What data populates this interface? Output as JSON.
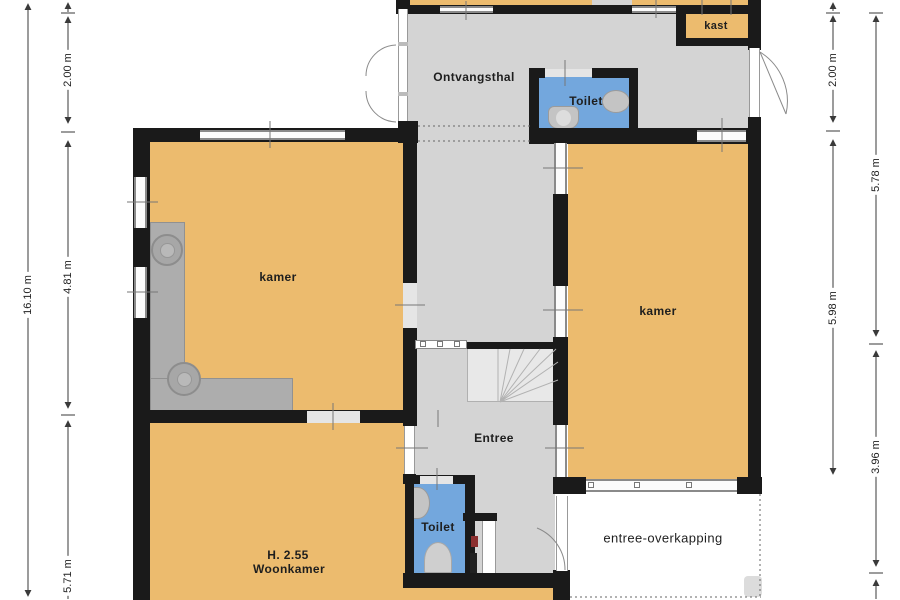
{
  "plan": {
    "rooms": {
      "ontvangsthal": "Ontvangsthal",
      "kast": "kast",
      "toilet_top": "Toilet",
      "kamer_left": "kamer",
      "kamer_right": "kamer",
      "entree": "Entree",
      "toilet_bottom": "Toilet",
      "woonkamer_height": "H. 2.55",
      "woonkamer": "Woonkamer",
      "entree_overkapping": "entree-overkapping"
    },
    "dimensions": {
      "left_total": "16.10 m",
      "left_top": "2.00 m",
      "left_middle": "4.81 m",
      "left_bottom": "5.71 m",
      "right_inner_top": "2.00 m",
      "right_inner_bottom": "5.98 m",
      "right_outer_top": "5.78 m",
      "right_outer_bottom": "3.96 m"
    }
  },
  "colors": {
    "wall": "#1a1a1a",
    "room-fill": "#ECBB6E",
    "hall-fill": "#D4D4D4",
    "wet-fill": "#73A7DD",
    "stairs-fill": "#E8E8E8",
    "counter-fill": "#ADADAD",
    "fixture-fill": "#C4C4C4",
    "dim-line": "#3a3a3a"
  }
}
